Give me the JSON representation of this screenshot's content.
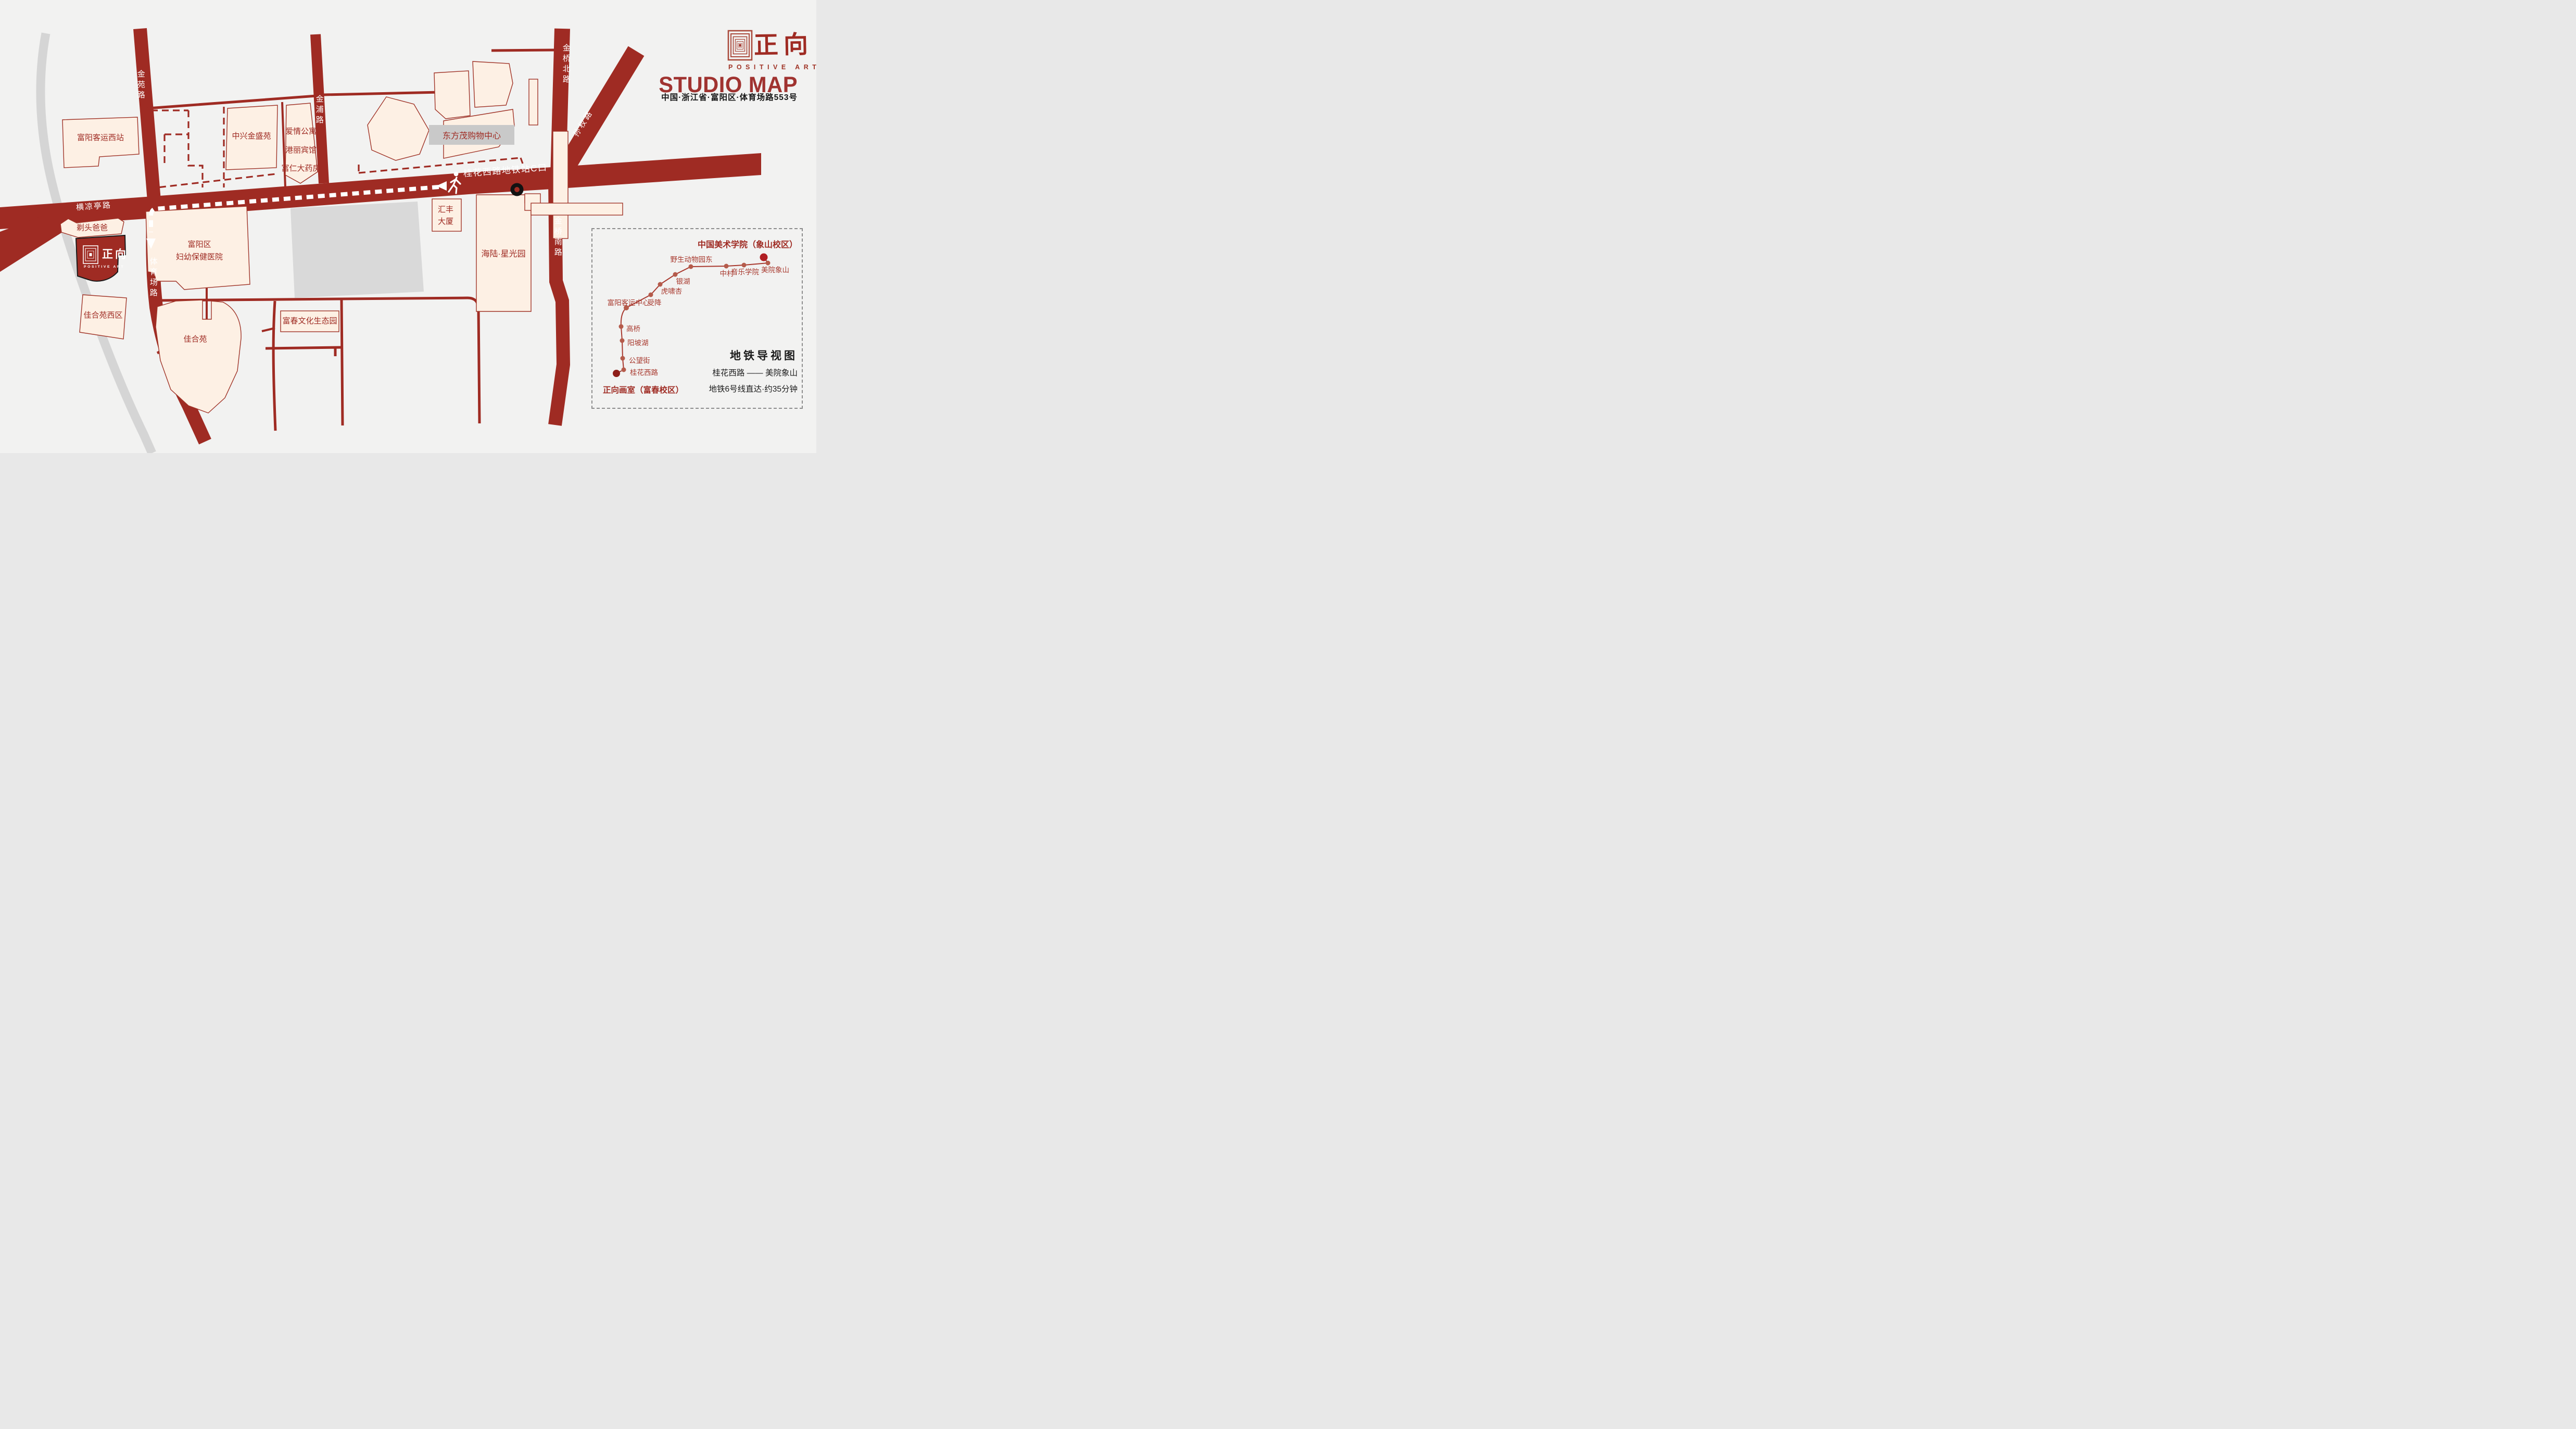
{
  "header": {
    "brand_cn": "正向",
    "brand_en": "POSITIVE ART",
    "title": "STUDIO MAP",
    "address": "中国·浙江省·富阳区·体育场路553号"
  },
  "map": {
    "roads": [
      {
        "label": "金苑路"
      },
      {
        "label": "金浦路"
      },
      {
        "label": "金桥北路"
      },
      {
        "label": "孙权路"
      },
      {
        "label": "金桥南路"
      },
      {
        "label": "体育场路"
      },
      {
        "label": "横凉亭路"
      }
    ],
    "metro_exit_label": "桂花西路地铁站C口",
    "buildings": [
      {
        "label": "富阳客运西站"
      },
      {
        "label": "中兴金盛苑"
      },
      {
        "label": "爱情公寓"
      },
      {
        "label": "港丽宾馆"
      },
      {
        "label": "富仁大药房"
      },
      {
        "label": "东方茂购物中心"
      },
      {
        "label": "汇丰大厦"
      },
      {
        "label": "海陆·星光园"
      },
      {
        "label": "富阳区妇幼保健医院",
        "line1": "富阳区",
        "line2": "妇幼保健医院"
      },
      {
        "label": "剃头爸爸"
      },
      {
        "label": "佳合苑西区"
      },
      {
        "label": "佳合苑"
      },
      {
        "label": "富春文化生态园"
      }
    ],
    "studio": {
      "name_cn": "正向",
      "name_en": "POSITIVE ART"
    }
  },
  "metro_panel": {
    "title": "地铁导视图",
    "route": "桂花西路 —— 美院象山",
    "duration": "地铁6号线直达·约35分钟",
    "origin": "正向画室（富春校区）",
    "destination": "中国美术学院（象山校区）",
    "stations": [
      "桂花西路",
      "公望街",
      "阳坡湖",
      "高桥",
      "富阳客运中心",
      "受降",
      "虎啸杏",
      "银湖",
      "野生动物园东",
      "中村",
      "音乐学院",
      "美院象山"
    ]
  },
  "colors": {
    "road": "#9f2b23",
    "building_fill": "#fdf0e4",
    "background": "#f2f2f1",
    "river_gray": "#d5d5d5",
    "block_gray": "#d9d9d9",
    "label_box_gray": "#c9c9c9",
    "metro_line": "#a8382e",
    "station_dot": "#b55b4b",
    "terminus_dot_dest": "#b01e23",
    "terminus_dot_origin": "#8e1e19",
    "text_black": "#1b1b1b"
  }
}
